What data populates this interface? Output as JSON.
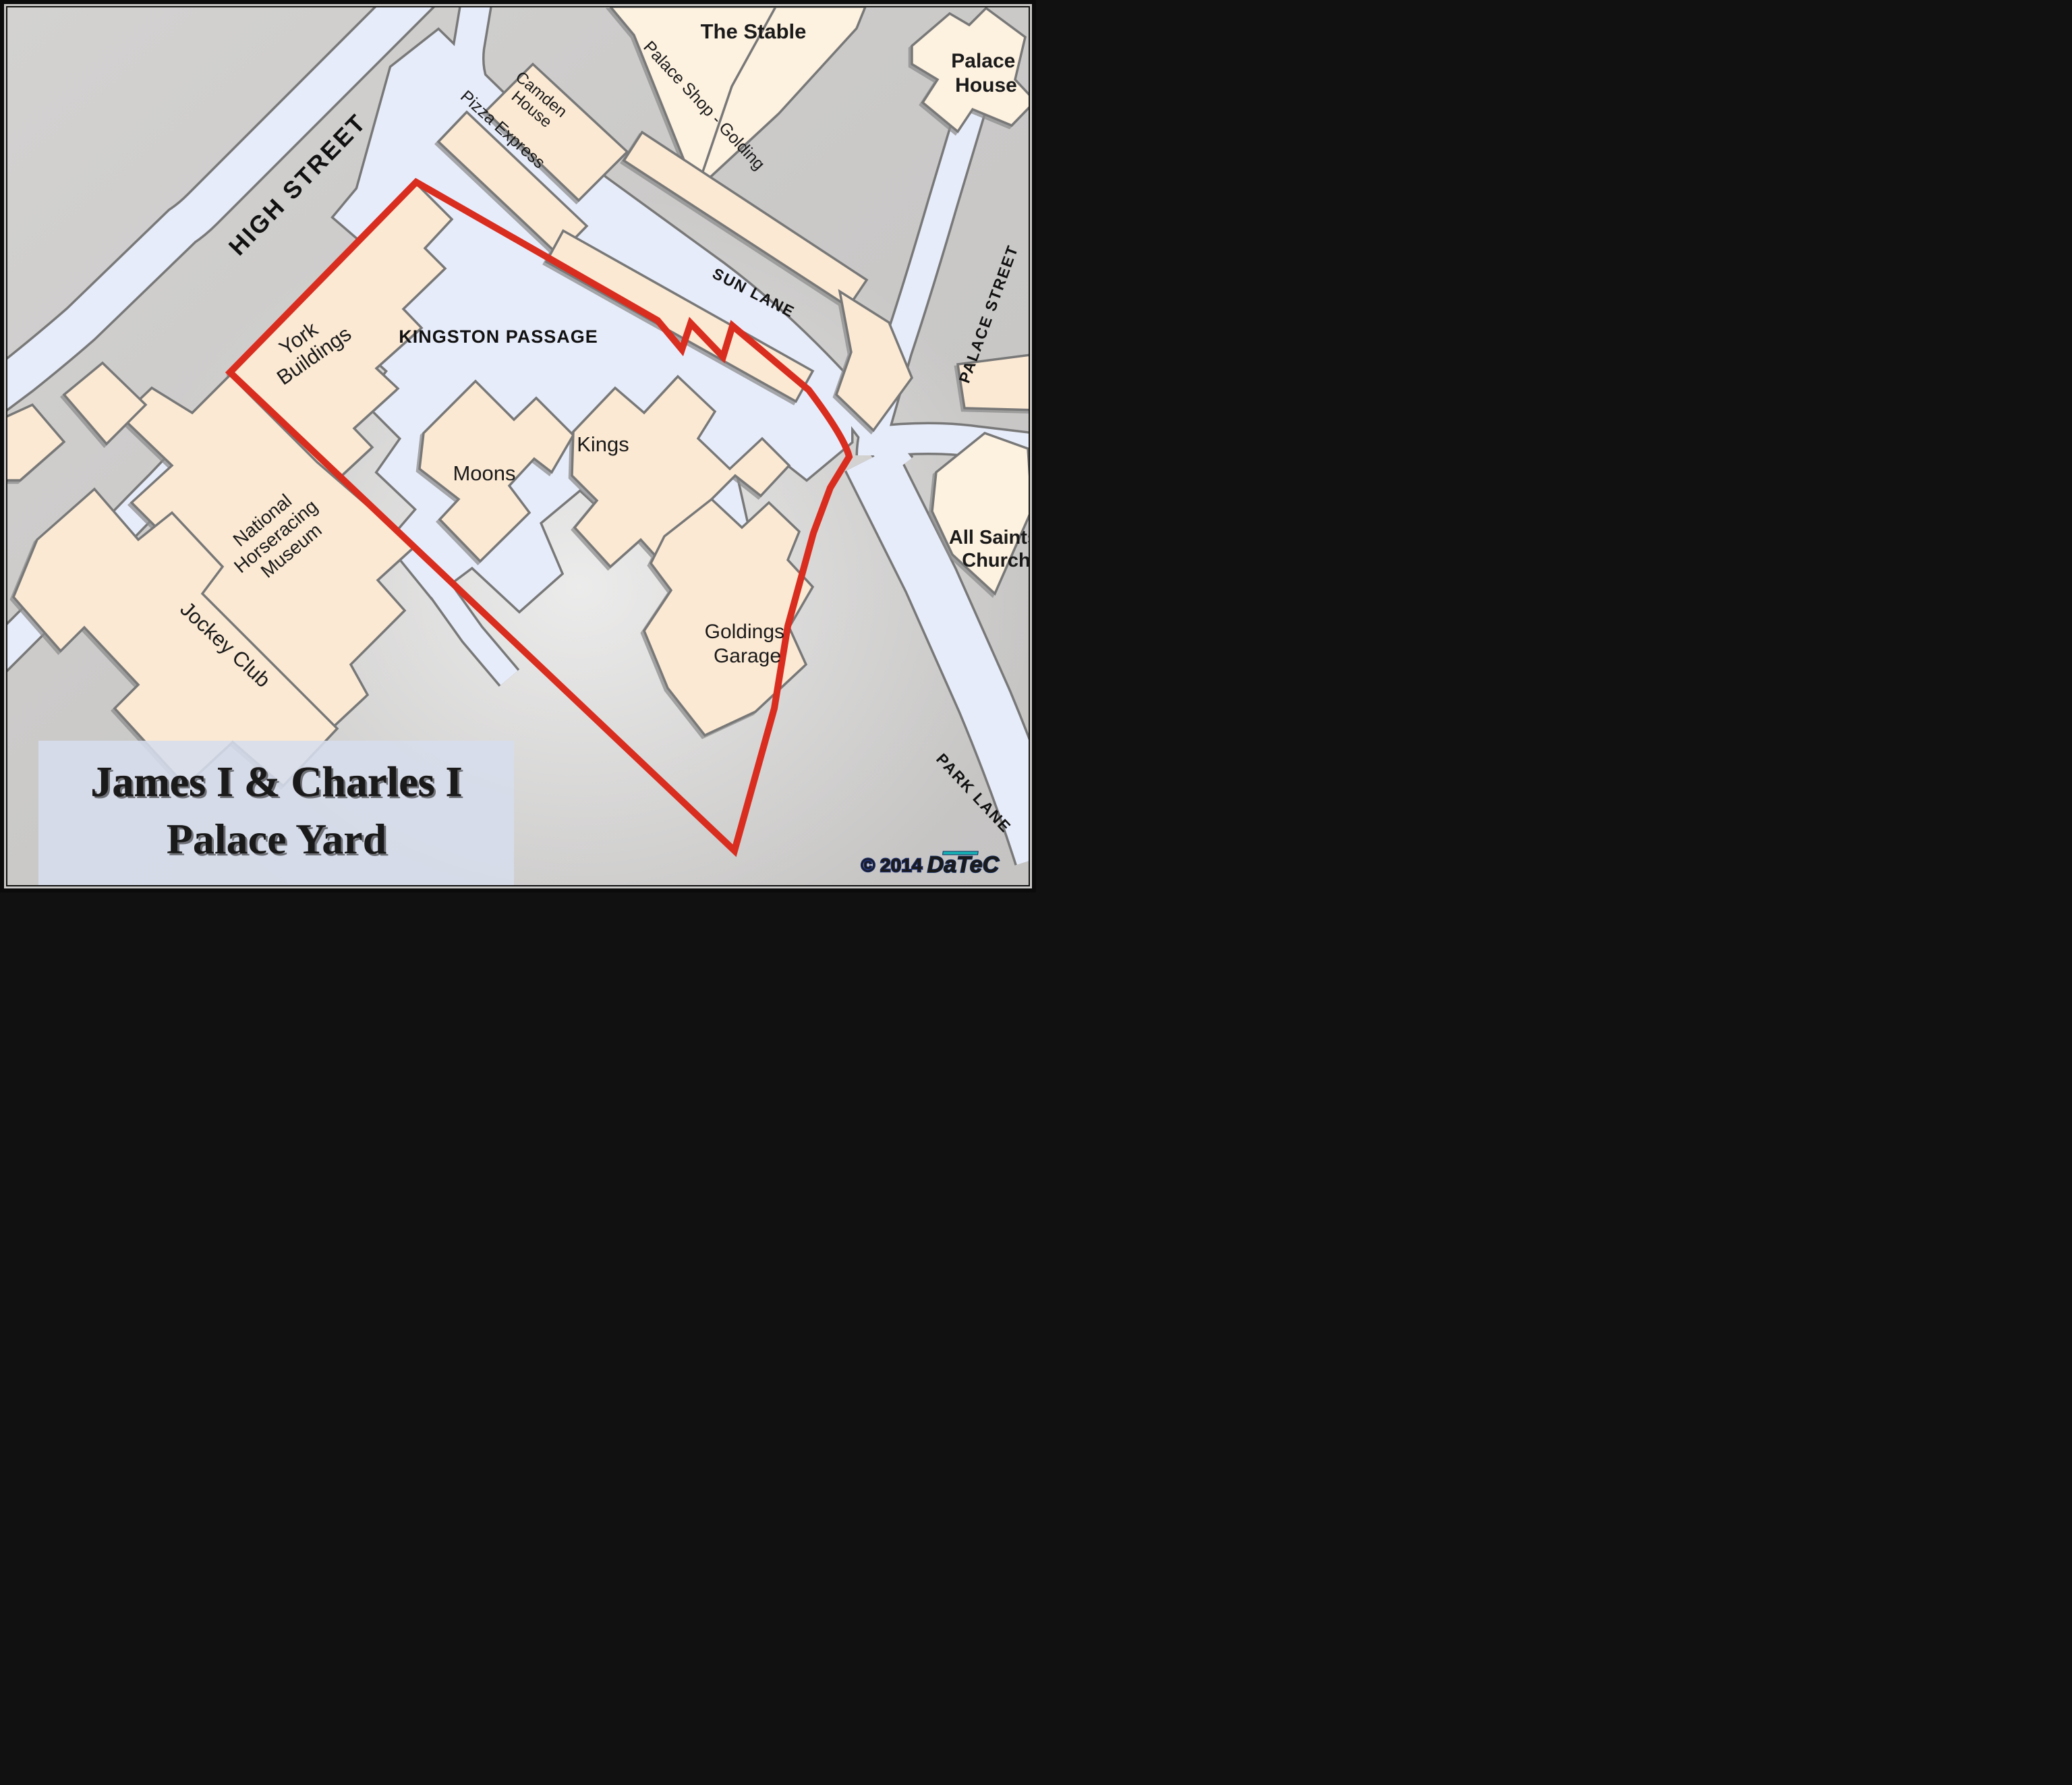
{
  "title": {
    "line1": "James I & Charles I",
    "line2": "Palace Yard"
  },
  "copyright": {
    "year_text": "© 2014",
    "brand": "DaTeC"
  },
  "streets": [
    {
      "id": "high-street",
      "label": "HIGH STREET"
    },
    {
      "id": "sun-lane",
      "label": "SUN LANE"
    },
    {
      "id": "palace-street",
      "label": "PALACE STREET"
    },
    {
      "id": "park-lane",
      "label": "PARK LANE"
    },
    {
      "id": "kingston-passage",
      "label": "KINGSTON PASSAGE"
    }
  ],
  "buildings": [
    {
      "id": "the-stable",
      "lines": [
        "The Stable"
      ]
    },
    {
      "id": "palace-shop-golding",
      "lines": [
        "Palace Shop - Golding"
      ]
    },
    {
      "id": "camden-house",
      "lines": [
        "Camden",
        "House"
      ]
    },
    {
      "id": "pizza-express",
      "lines": [
        "Pizza Express"
      ]
    },
    {
      "id": "palace-house",
      "lines": [
        "Palace",
        "House"
      ]
    },
    {
      "id": "york-buildings",
      "lines": [
        "York",
        "Buildings"
      ]
    },
    {
      "id": "moons",
      "lines": [
        "Moons"
      ]
    },
    {
      "id": "kings",
      "lines": [
        "Kings"
      ]
    },
    {
      "id": "national-horseracing-museum",
      "lines": [
        "National",
        "Horseracing",
        "Museum"
      ]
    },
    {
      "id": "jockey-club",
      "lines": [
        "Jockey Club"
      ]
    },
    {
      "id": "goldings-garage",
      "lines": [
        "Goldings",
        "Garage"
      ]
    },
    {
      "id": "all-saints-church",
      "lines": [
        "All Saints",
        "Church"
      ]
    }
  ],
  "overlay": {
    "name": "palace-yard-boundary",
    "color": "#d92d1f"
  },
  "colors": {
    "background": "#cbcac9",
    "street_fill": "#e7ecfa",
    "building_fill": "#fbe9d3",
    "building_fill_light": "#fdf1e0",
    "border_gray": "#787878",
    "title_red": "#c2272b",
    "title_panel": "#d6ddec",
    "brand_teal": "#15b3b5",
    "brand_navy": "#1d2d6b"
  }
}
